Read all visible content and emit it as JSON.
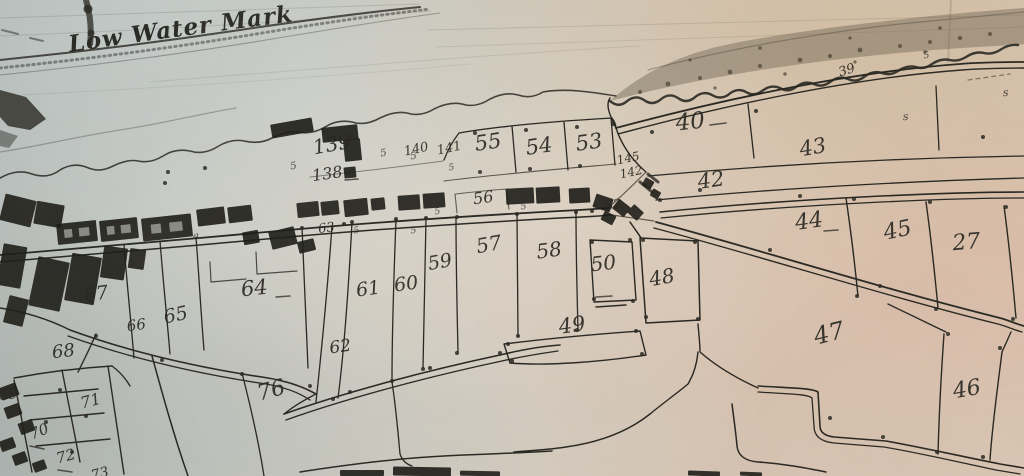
{
  "annotation": {
    "low_water_mark": "Low Water Mark"
  },
  "colors": {
    "ink": "#24231e",
    "building": "#171713",
    "veg": "#6e6453",
    "paper_left": "#c3c8c6",
    "paper_right": "#dcc5b2"
  },
  "plots": [
    {
      "n": "139",
      "x": 333,
      "y": 151,
      "s": 20,
      "r": -10
    },
    {
      "n": "138",
      "x": 328,
      "y": 179,
      "s": 16,
      "r": -8
    },
    {
      "n": "140",
      "x": 417,
      "y": 153,
      "s": 13,
      "r": -12
    },
    {
      "n": "141",
      "x": 450,
      "y": 152,
      "s": 13,
      "r": -12
    },
    {
      "n": "55",
      "x": 489,
      "y": 149,
      "s": 21,
      "r": -8
    },
    {
      "n": "54",
      "x": 540,
      "y": 153,
      "s": 21,
      "r": -8
    },
    {
      "n": "53",
      "x": 590,
      "y": 149,
      "s": 21,
      "r": -8
    },
    {
      "n": "40",
      "x": 691,
      "y": 129,
      "s": 23,
      "r": -6
    },
    {
      "n": "39",
      "x": 848,
      "y": 74,
      "s": 13,
      "r": -18
    },
    {
      "n": "43",
      "x": 814,
      "y": 154,
      "s": 21,
      "r": -10
    },
    {
      "n": "42",
      "x": 712,
      "y": 187,
      "s": 21,
      "r": -8
    },
    {
      "n": "145",
      "x": 629,
      "y": 162,
      "s": 12,
      "r": -12
    },
    {
      "n": "142",
      "x": 632,
      "y": 176,
      "s": 12,
      "r": -12
    },
    {
      "n": "52",
      "x": 614,
      "y": 209,
      "s": 13,
      "r": -10
    },
    {
      "n": "44",
      "x": 810,
      "y": 228,
      "s": 22,
      "r": -8
    },
    {
      "n": "45",
      "x": 899,
      "y": 237,
      "s": 22,
      "r": -12
    },
    {
      "n": "27",
      "x": 967,
      "y": 249,
      "s": 22,
      "r": -5
    },
    {
      "n": "56",
      "x": 484,
      "y": 203,
      "s": 16,
      "r": -8
    },
    {
      "n": "57",
      "x": 490,
      "y": 251,
      "s": 20,
      "r": -10
    },
    {
      "n": "58",
      "x": 550,
      "y": 257,
      "s": 20,
      "r": -8
    },
    {
      "n": "50",
      "x": 604,
      "y": 270,
      "s": 20,
      "r": -6
    },
    {
      "n": "48",
      "x": 663,
      "y": 284,
      "s": 20,
      "r": -10
    },
    {
      "n": "49",
      "x": 573,
      "y": 332,
      "s": 21,
      "r": -8
    },
    {
      "n": "47",
      "x": 831,
      "y": 341,
      "s": 24,
      "r": -14
    },
    {
      "n": "46",
      "x": 968,
      "y": 396,
      "s": 22,
      "r": -10
    },
    {
      "n": "59",
      "x": 441,
      "y": 268,
      "s": 19,
      "r": -10
    },
    {
      "n": "60",
      "x": 407,
      "y": 290,
      "s": 19,
      "r": -8
    },
    {
      "n": "61",
      "x": 369,
      "y": 295,
      "s": 19,
      "r": -8
    },
    {
      "n": "62",
      "x": 341,
      "y": 352,
      "s": 17,
      "r": -8
    },
    {
      "n": "63",
      "x": 327,
      "y": 232,
      "s": 13,
      "r": -8
    },
    {
      "n": "64",
      "x": 255,
      "y": 295,
      "s": 21,
      "r": -6
    },
    {
      "n": "65",
      "x": 177,
      "y": 321,
      "s": 19,
      "r": -12
    },
    {
      "n": "66",
      "x": 137,
      "y": 330,
      "s": 15,
      "r": -8
    },
    {
      "n": "67",
      "x": 97,
      "y": 300,
      "s": 19,
      "r": -8
    },
    {
      "n": "68",
      "x": 64,
      "y": 357,
      "s": 18,
      "r": -6
    },
    {
      "n": "69",
      "x": 9,
      "y": 399,
      "s": 15,
      "r": -8
    },
    {
      "n": "70",
      "x": 41,
      "y": 436,
      "s": 15,
      "r": -22
    },
    {
      "n": "71",
      "x": 92,
      "y": 406,
      "s": 16,
      "r": -15
    },
    {
      "n": "72",
      "x": 67,
      "y": 461,
      "s": 15,
      "r": -15
    },
    {
      "n": "73",
      "x": 101,
      "y": 478,
      "s": 14,
      "r": -15
    },
    {
      "n": "76",
      "x": 273,
      "y": 397,
      "s": 22,
      "r": -15
    }
  ],
  "marks": [
    {
      "t": "5",
      "x": 294,
      "y": 169,
      "s": 10,
      "r": -10
    },
    {
      "t": "5",
      "x": 384,
      "y": 156,
      "s": 10,
      "r": -10
    },
    {
      "t": "5",
      "x": 414,
      "y": 159,
      "s": 10,
      "r": -10
    },
    {
      "t": "5",
      "x": 452,
      "y": 170,
      "s": 9,
      "r": -10
    },
    {
      "t": "5",
      "x": 357,
      "y": 233,
      "s": 9,
      "r": -10
    },
    {
      "t": "5",
      "x": 414,
      "y": 233,
      "s": 9,
      "r": -10
    },
    {
      "t": "5",
      "x": 438,
      "y": 214,
      "s": 9,
      "r": -10
    },
    {
      "t": "5",
      "x": 524,
      "y": 209,
      "s": 9,
      "r": -10
    },
    {
      "t": "s",
      "x": 906,
      "y": 120,
      "s": 11,
      "r": -5
    },
    {
      "t": "s",
      "x": 1006,
      "y": 96,
      "s": 11,
      "r": -5
    },
    {
      "t": "5",
      "x": 927,
      "y": 58,
      "s": 9,
      "r": -10
    },
    {
      "t": "a",
      "x": 196,
      "y": 239,
      "s": 10,
      "r": 0
    }
  ],
  "dashes": [
    [
      710,
      125,
      726,
      123
    ],
    [
      824,
      231,
      838,
      230
    ],
    [
      276,
      297,
      290,
      296
    ],
    [
      596,
      297,
      612,
      296
    ],
    [
      345,
      180,
      358,
      179
    ],
    [
      30,
      446,
      44,
      449
    ],
    [
      58,
      470,
      72,
      472
    ]
  ],
  "dots": [
    [
      168,
      172
    ],
    [
      165,
      183
    ],
    [
      205,
      168
    ],
    [
      475,
      133
    ],
    [
      526,
      130
    ],
    [
      577,
      127
    ],
    [
      613,
      124
    ],
    [
      480,
      172
    ],
    [
      530,
      169
    ],
    [
      580,
      166
    ],
    [
      352,
      222
    ],
    [
      396,
      219
    ],
    [
      426,
      218
    ],
    [
      457,
      217
    ],
    [
      517,
      214
    ],
    [
      576,
      212
    ],
    [
      592,
      211
    ],
    [
      333,
      399
    ],
    [
      392,
      381
    ],
    [
      423,
      369
    ],
    [
      457,
      353
    ],
    [
      518,
      336
    ],
    [
      577,
      330
    ],
    [
      508,
      344
    ],
    [
      636,
      331
    ],
    [
      512,
      361
    ],
    [
      642,
      354
    ],
    [
      592,
      242
    ],
    [
      630,
      240
    ],
    [
      594,
      299
    ],
    [
      633,
      301
    ],
    [
      643,
      240
    ],
    [
      695,
      242
    ],
    [
      646,
      317
    ],
    [
      698,
      319
    ],
    [
      800,
      196
    ],
    [
      854,
      199
    ],
    [
      930,
      202
    ],
    [
      1006,
      207
    ],
    [
      857,
      296
    ],
    [
      936,
      309
    ],
    [
      1013,
      319
    ],
    [
      652,
      132
    ],
    [
      756,
      111
    ],
    [
      770,
      250
    ],
    [
      880,
      286
    ],
    [
      983,
      137
    ],
    [
      948,
      334
    ],
    [
      1000,
      348
    ],
    [
      937,
      452
    ],
    [
      983,
      457
    ],
    [
      830,
      418
    ],
    [
      883,
      437
    ],
    [
      96,
      336
    ],
    [
      60,
      390
    ],
    [
      86,
      416
    ],
    [
      46,
      422
    ],
    [
      72,
      452
    ],
    [
      162,
      360
    ],
    [
      242,
      374
    ],
    [
      310,
      386
    ],
    [
      350,
      392
    ],
    [
      430,
      368
    ],
    [
      500,
      353
    ],
    [
      302,
      228
    ],
    [
      344,
      224
    ],
    [
      660,
      200
    ],
    [
      700,
      190
    ]
  ],
  "veg_dots": [
    [
      640,
      92,
      2
    ],
    [
      668,
      84,
      2.4
    ],
    [
      700,
      78,
      2
    ],
    [
      730,
      72,
      2.4
    ],
    [
      760,
      66,
      2
    ],
    [
      800,
      60,
      2.4
    ],
    [
      830,
      56,
      2
    ],
    [
      860,
      50,
      2.4
    ],
    [
      900,
      46,
      2
    ],
    [
      930,
      42,
      2
    ],
    [
      960,
      38,
      2.2
    ],
    [
      990,
      34,
      2
    ],
    [
      715,
      88,
      1.6
    ],
    [
      785,
      74,
      1.8
    ],
    [
      855,
      62,
      1.6
    ],
    [
      925,
      52,
      1.8
    ],
    [
      690,
      60,
      1.6
    ],
    [
      760,
      48,
      1.8
    ],
    [
      850,
      38,
      1.6
    ],
    [
      940,
      28,
      1.8
    ]
  ],
  "buildings": [
    {
      "x": 322,
      "y": 126,
      "w": 36,
      "h": 15,
      "r": -6
    },
    {
      "x": 344,
      "y": 139,
      "w": 17,
      "h": 22,
      "r": -6
    },
    {
      "x": 344,
      "y": 167,
      "w": 12,
      "h": 11,
      "r": -6
    },
    {
      "x": 271,
      "y": 121,
      "w": 42,
      "h": 14,
      "r": -10
    },
    {
      "x": 57,
      "y": 222,
      "w": 40,
      "h": 21,
      "r": -6,
      "l": 1
    },
    {
      "x": 100,
      "y": 219,
      "w": 38,
      "h": 21,
      "r": -6,
      "l": 1
    },
    {
      "x": 142,
      "y": 216,
      "w": 50,
      "h": 23,
      "r": -6,
      "l": 1
    },
    {
      "x": 197,
      "y": 208,
      "w": 28,
      "h": 17,
      "r": -7
    },
    {
      "x": 228,
      "y": 206,
      "w": 24,
      "h": 16,
      "r": -7
    },
    {
      "x": 297,
      "y": 202,
      "w": 22,
      "h": 15,
      "r": -6
    },
    {
      "x": 321,
      "y": 201,
      "w": 18,
      "h": 14,
      "r": -6
    },
    {
      "x": 344,
      "y": 199,
      "w": 24,
      "h": 17,
      "r": -6
    },
    {
      "x": 371,
      "y": 198,
      "w": 14,
      "h": 12,
      "r": -6
    },
    {
      "x": 398,
      "y": 195,
      "w": 22,
      "h": 15,
      "r": -4
    },
    {
      "x": 423,
      "y": 193,
      "w": 22,
      "h": 15,
      "r": -4
    },
    {
      "x": 506,
      "y": 188,
      "w": 28,
      "h": 16,
      "r": -3
    },
    {
      "x": 536,
      "y": 187,
      "w": 24,
      "h": 16,
      "r": -3
    },
    {
      "x": 569,
      "y": 188,
      "w": 21,
      "h": 15,
      "r": -3
    },
    {
      "x": 594,
      "y": 196,
      "w": 18,
      "h": 14,
      "r": 18
    },
    {
      "x": 614,
      "y": 202,
      "w": 15,
      "h": 12,
      "r": 38
    },
    {
      "x": 602,
      "y": 213,
      "w": 13,
      "h": 10,
      "r": 28
    },
    {
      "x": 629,
      "y": 207,
      "w": 13,
      "h": 11,
      "r": 42
    },
    {
      "x": 643,
      "y": 179,
      "w": 10,
      "h": 9,
      "r": 30
    },
    {
      "x": 651,
      "y": 190,
      "w": 9,
      "h": 8,
      "r": 30
    },
    {
      "x": 243,
      "y": 231,
      "w": 16,
      "h": 13,
      "r": -10
    },
    {
      "x": 270,
      "y": 229,
      "w": 26,
      "h": 18,
      "r": -14
    },
    {
      "x": 298,
      "y": 240,
      "w": 17,
      "h": 12,
      "r": -14
    },
    {
      "x": 2,
      "y": 197,
      "w": 32,
      "h": 27,
      "r": 14
    },
    {
      "x": 35,
      "y": 203,
      "w": 28,
      "h": 23,
      "r": 10
    },
    {
      "x": 0,
      "y": 245,
      "w": 24,
      "h": 42,
      "r": 10
    },
    {
      "x": 33,
      "y": 259,
      "w": 32,
      "h": 50,
      "r": 12
    },
    {
      "x": 68,
      "y": 255,
      "w": 30,
      "h": 48,
      "r": 10
    },
    {
      "x": 102,
      "y": 247,
      "w": 24,
      "h": 32,
      "r": 8
    },
    {
      "x": 6,
      "y": 297,
      "w": 20,
      "h": 28,
      "r": 14
    },
    {
      "x": 129,
      "y": 249,
      "w": 16,
      "h": 20,
      "r": 8
    },
    {
      "x": 0,
      "y": 385,
      "w": 18,
      "h": 13,
      "r": -20
    },
    {
      "x": 5,
      "y": 405,
      "w": 16,
      "h": 12,
      "r": -20
    },
    {
      "x": 19,
      "y": 421,
      "w": 15,
      "h": 12,
      "r": -20
    },
    {
      "x": 0,
      "y": 439,
      "w": 15,
      "h": 11,
      "r": -20
    },
    {
      "x": 13,
      "y": 453,
      "w": 14,
      "h": 11,
      "r": -20
    },
    {
      "x": 33,
      "y": 461,
      "w": 13,
      "h": 10,
      "r": -20
    },
    {
      "x": 340,
      "y": 470,
      "w": 44,
      "h": 6,
      "r": 0
    },
    {
      "x": 393,
      "y": 467,
      "w": 58,
      "h": 9,
      "r": 1
    },
    {
      "x": 460,
      "y": 471,
      "w": 40,
      "h": 5,
      "r": 1
    },
    {
      "x": 688,
      "y": 471,
      "w": 32,
      "h": 5,
      "r": 2
    },
    {
      "x": 740,
      "y": 472,
      "w": 22,
      "h": 4,
      "r": 2
    }
  ]
}
